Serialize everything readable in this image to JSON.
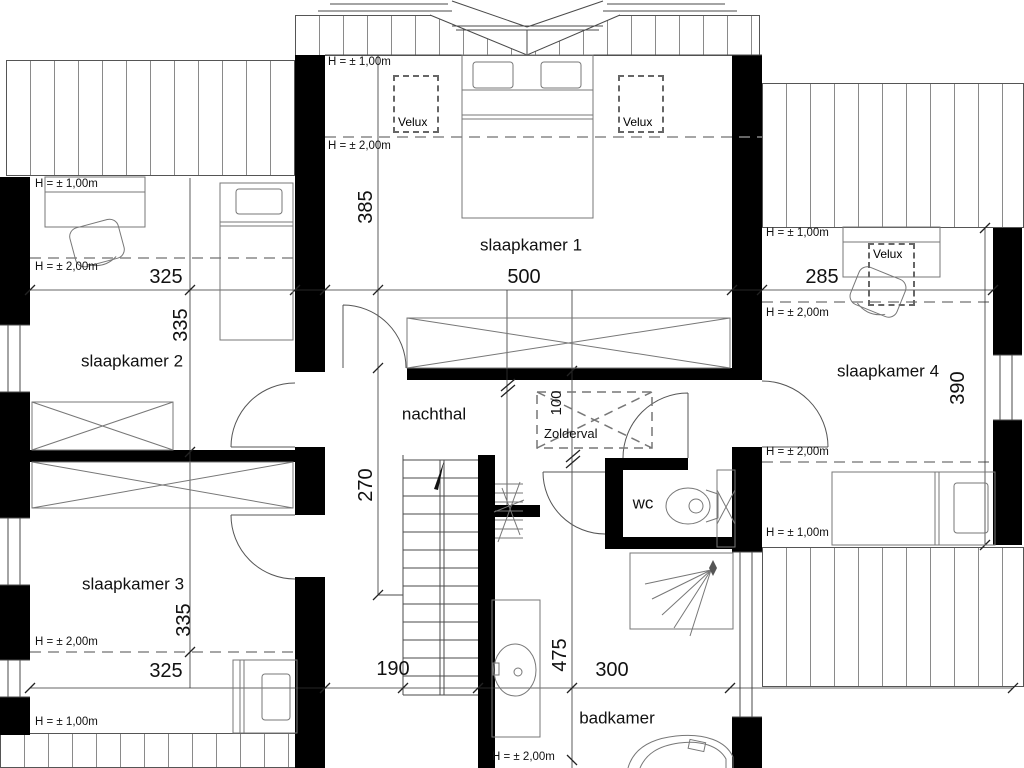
{
  "rooms": {
    "r1": "slaapkamer 1",
    "r2": "slaapkamer 2",
    "r3": "slaapkamer 3",
    "r4": "slaapkamer 4",
    "hall": "nachthal",
    "wc": "wc",
    "bath": "badkamer"
  },
  "dims": {
    "r1_w": "500",
    "r1_d": "385",
    "r2_w": "325",
    "r2_d": "335",
    "r3_w": "325",
    "r3_d": "335",
    "r4_w": "285",
    "r4_d": "390",
    "hall_d": "270",
    "hatch_d": "100",
    "stair_w": "190",
    "bath_w": "300",
    "bath_d": "475"
  },
  "notes": {
    "h100": "H = ± 1,00m",
    "h200": "H = ± 2,00m",
    "velux": "Velux",
    "zolderval": "Zolderval"
  },
  "colors": {
    "wall": "#000000",
    "line": "#4a4a4a",
    "furniture": "#777777",
    "text": "#111111"
  }
}
